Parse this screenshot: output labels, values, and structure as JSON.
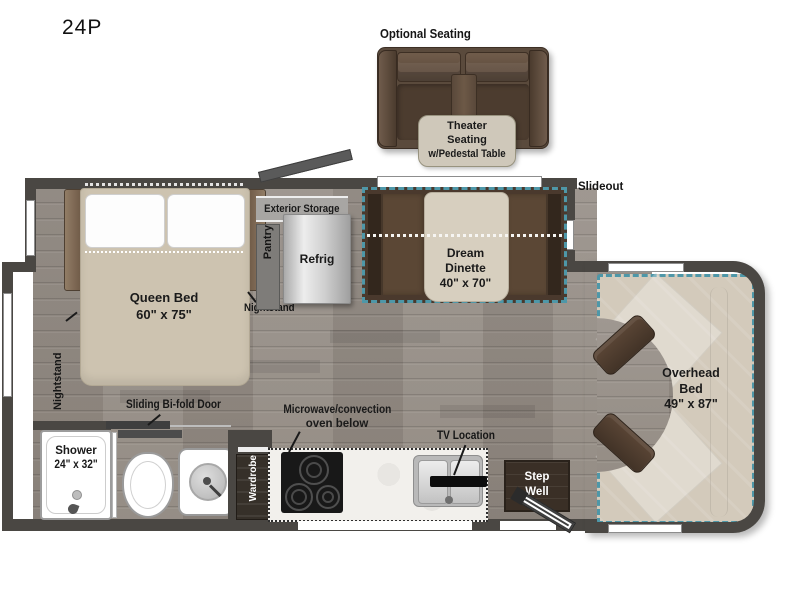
{
  "model": "24P",
  "optional_seating": {
    "heading": "Optional Seating",
    "callout": {
      "line1": "Theater",
      "line2": "Seating",
      "line3": "w/Pedestal Table"
    }
  },
  "slideout_label": "Slideout",
  "bedroom": {
    "bed_name": "Queen Bed",
    "bed_dims": "60\" x 75\"",
    "nightstand_left": "Nightstand",
    "nightstand_right": "Nightstand"
  },
  "galley": {
    "exterior_storage": "Exterior Storage",
    "pantry": "Pantry",
    "refrig": "Refrig",
    "microwave_line1": "Microwave/convection",
    "microwave_line2": "oven below",
    "tv_location": "TV Location",
    "wardrobe": "Wardrobe"
  },
  "dinette": {
    "line1": "Dream",
    "line2": "Dinette",
    "dims": "40\" x 70\""
  },
  "cab": {
    "line1": "Overhead",
    "line2": "Bed",
    "dims": "49\" x 87\""
  },
  "bath": {
    "shower_name": "Shower",
    "shower_dims": "24\" x 32\"",
    "sliding_door": "Sliding Bi-fold Door"
  },
  "step_well": {
    "line1": "Step",
    "line2": "Well"
  },
  "colors": {
    "wall": "#4a4743",
    "floor": "#99918a",
    "slideout_accent": "#4e97a8",
    "furniture_beige": "#d3cabb",
    "bench_brown": "#5a4636",
    "sofa_brown": "#5d4b3d",
    "callout_bg": "#cfc8ba",
    "step_well_bg": "#3a2f26"
  }
}
